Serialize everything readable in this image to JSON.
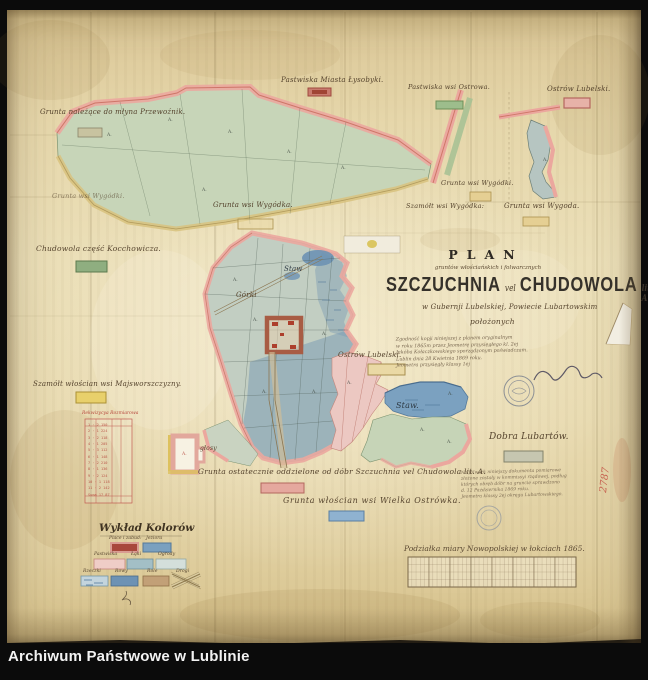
{
  "frame": {
    "archive_label": "Archiwum Państwowe w Lublinie"
  },
  "title_block": {
    "plan_word": "PLAN",
    "script_line": "gruntów włościańskich i folwarcznych",
    "main_left": "SZCZUCHNIA",
    "vel_word": "vel",
    "main_right": "CHUDOWOLA",
    "lit_suffix": "lit. A.",
    "location_line": "w Gubernji Lubelskiej, Powiecie Lubartowskim",
    "located_word": "położonych",
    "certification_note": "Zgodność kopji niniejszej z planem oryginalnym\nw roku 1865m przez Jeometrę przysięgłego kl. 2ej\nJakóba Kołaczkowskiego sporządzonym poświadczam.\nLublin dnia 28 Kwietnia 1869 roku.\nJeometra przysięgły klassy 1ej"
  },
  "labels": {
    "mill": "Grunta należące do młyna Przewoźnik.",
    "lysobyki": "Pastwiska Miasta Łysobyki.",
    "ostrowa_pastures": "Pastwiska wsi Ostrowa.",
    "ostrow_top": "Ostrów Lubelski.",
    "wygodki_left": "Grunta wsi Wygódki.",
    "wygodka_mid": "Grunta wsi Wygódka.",
    "szamotel": "Szamółt wsi Wygódka:",
    "wygodki_right": "Grunta wsi Wygódki.",
    "wygoda_right": "Grunta wsi Wygoda.",
    "chudowola_part": "Chudowola część Kocchowicza.",
    "majsworszczyzna": "Szamółt włościan wsi Majsworszczyzny.",
    "ostrow_mid": "Ostrów Lubelski.",
    "glosy": "głosy",
    "separated": "Grunta ostatecznie oddzielone od dóbr Szczuchnia vel Chudowola lit. A.",
    "ostrowka": "Grunta włościan wsi Wielka Ostrówka.",
    "dobra": "Dobra Lubartów.",
    "dobra_note": "Na folwark niniejszy dokumenta pomiarowe\nzłożone zostały w kommissyi rządowej, podług\nktórych obręb dóbr na gruncie sprawdzono\nd. 12 Października 1869 roku.\nJeometra klassy 2ej okręgu Lubartowskiego.",
    "staw_upper": "Staw",
    "staw_lower": "Staw.",
    "gorki": "Górki",
    "parcel_mark": "A."
  },
  "survey_table": {
    "title": "Rekwizycya Rozmiarowa",
    "rows": "1 ·  2 150\n2 ·  1 224\n3 ·  2 118\n4 ·  1 205\n5 ·  3 112\n6 ·  1 148\n7 ·  2 210\n8 ·  1 136\n9 ·  2 124\n10 · 1 118\n11 · 2 142\nSuma 17 87"
  },
  "legend": {
    "title": "Wykład Kolorów",
    "items": [
      {
        "label": "Place i zabud:",
        "color": "#a8473c"
      },
      {
        "label": "Jeziora",
        "color": "#7aa0bf"
      },
      {
        "label": "Pastwiska",
        "color": "#efcdc7"
      },
      {
        "label": "Łąki",
        "color": "#a3bfc6"
      },
      {
        "label": "Ogrody",
        "color": "#d4dfdb"
      },
      {
        "label": "Rzeczki",
        "color": "#c3d4dd"
      },
      {
        "label": "Rowy",
        "color": "#6d92b4"
      },
      {
        "label": "Role",
        "color": "#c2a077"
      },
      {
        "label": "Drogi",
        "color": "#efe9d6"
      }
    ]
  },
  "scale_bar": {
    "caption": "Podziałka miary Nowopolskiej w łokciach 1865."
  },
  "annotations": {
    "red_number": "2787"
  }
}
